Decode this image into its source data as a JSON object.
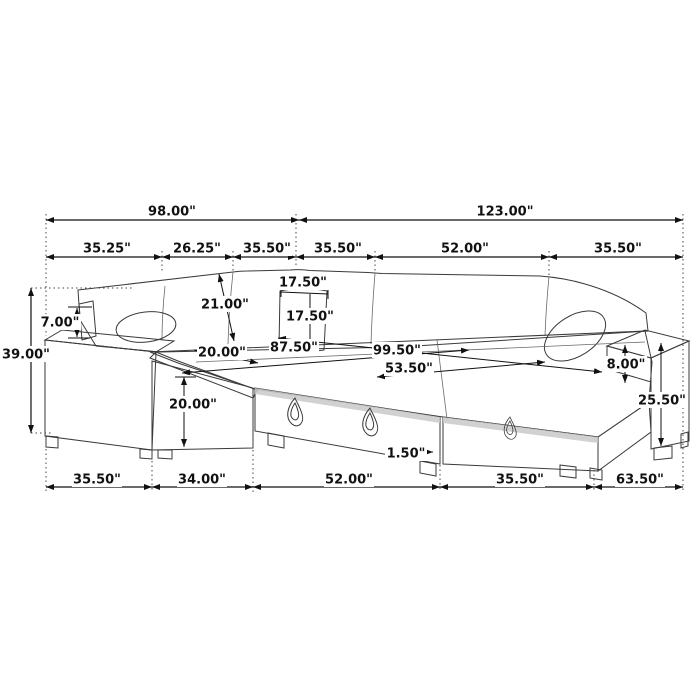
{
  "diagram_type": "sectional-sofa-dimension-drawing",
  "colors": {
    "background": "#ffffff",
    "line": "#3a3a3a",
    "dimension_line": "#111111",
    "label_text": "#111111",
    "shaded_surface": "#b4b4b4"
  },
  "dims": {
    "overall_top_left": "98.00\"",
    "overall_top_right": "123.00\"",
    "top_segments": [
      "35.25\"",
      "26.25\"",
      "35.50\"",
      "35.50\"",
      "52.00\"",
      "35.50\""
    ],
    "overall_height": "39.00\"",
    "arm_pillow_height": "7.00\"",
    "back_cushion_depth": "21.00\"",
    "corner_cushion_width": "17.50\"",
    "corner_cushion_height": "17.50\"",
    "chaise_seat_width": "20.00\"",
    "seat_span": "87.50\"",
    "bed_span": "99.50\"",
    "bed_depth": "53.50\"",
    "seat_height": "20.00\"",
    "leg_height": "1.50\"",
    "arm_above_seat": "8.00\"",
    "right_arm_height": "25.50\"",
    "bottom_segments": [
      "35.50\"",
      "34.00\"",
      "52.00\"",
      "35.50\"",
      "63.50\""
    ]
  }
}
